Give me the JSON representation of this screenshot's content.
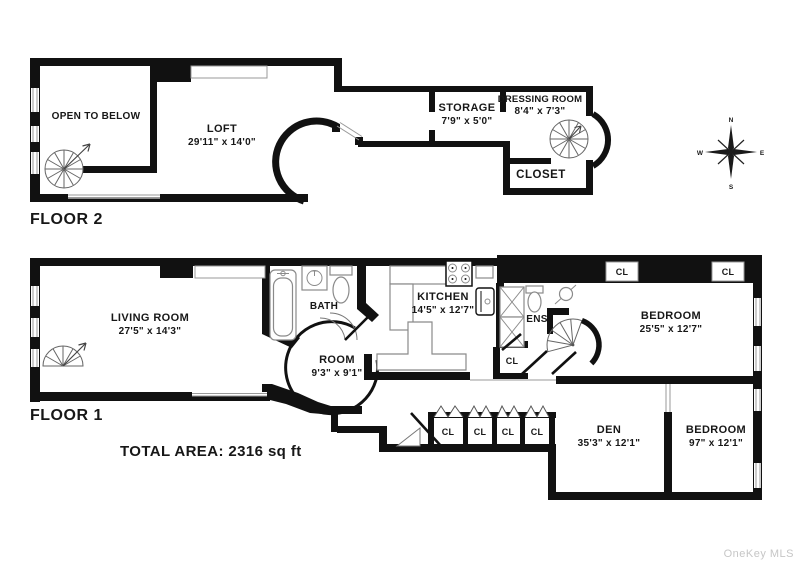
{
  "floor2": {
    "label": "FLOOR 2",
    "open_to_below": "OPEN TO BELOW",
    "loft_name": "LOFT",
    "loft_dims": "29'11\" x 14'0\"",
    "storage_name": "STORAGE",
    "storage_dims": "7'9\" x 5'0\"",
    "dressing_name": "DRESSING ROOM",
    "dressing_dims": "8'4\" x 7'3\"",
    "closet": "CLOSET"
  },
  "floor1": {
    "label": "FLOOR 1",
    "total_area": "TOTAL AREA: 2316 sq ft",
    "living_name": "LIVING ROOM",
    "living_dims": "27'5\" x 14'3\"",
    "bath": "BATH",
    "kitchen_name": "KITCHEN",
    "kitchen_dims": "14'5\" x 12'7\"",
    "room_name": "ROOM",
    "room_dims": "9'3\" x 9'1\"",
    "ens": "ENS",
    "bedroom1_name": "BEDROOM",
    "bedroom1_dims": "25'5\" x 12'7\"",
    "den_name": "DEN",
    "den_dims": "35'3\" x 12'1\"",
    "bedroom2_name": "BEDROOM",
    "bedroom2_dims": "97\" x 12'1\"",
    "closet_abbr": "CL"
  },
  "compass": {
    "north": "N",
    "east": "E",
    "south": "S",
    "west": "W"
  },
  "watermark": "OneKey MLS",
  "colors": {
    "wall": "#111111",
    "fixture_outline": "#8a8a8a",
    "watermark": "#c6c6c6"
  }
}
